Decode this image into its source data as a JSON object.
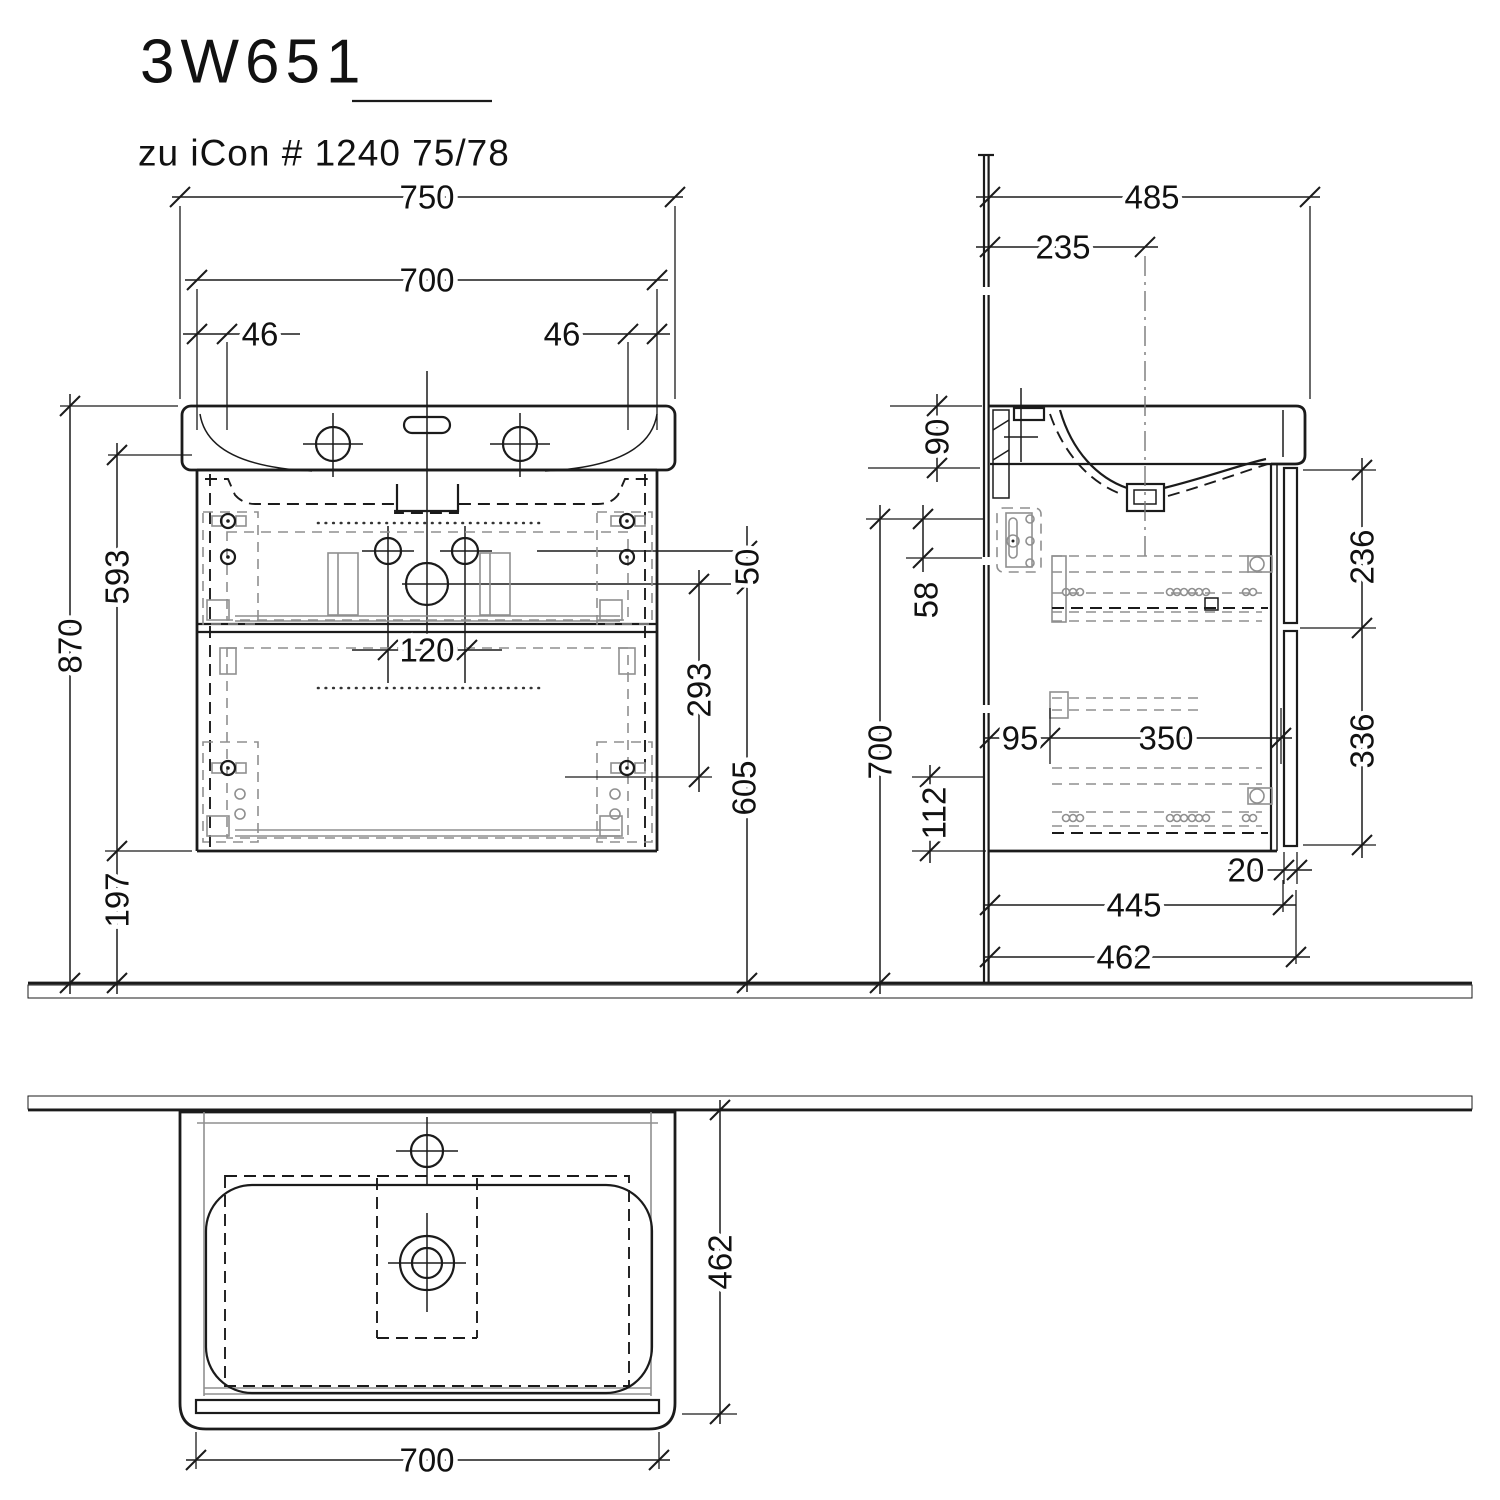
{
  "drawing": {
    "title": "3W651",
    "subtitle": "zu iCon # 1240 75/78",
    "type": "vanity-unit-technical-drawing",
    "line_color": "#1b1b1b",
    "hardware_color": "#8f8f8f",
    "views": [
      "front-view",
      "side-view",
      "plan-view"
    ]
  },
  "dims": {
    "front": {
      "total_width": "750",
      "cabinet_width": "700",
      "left_offset": "46",
      "right_offset": "46",
      "hole_spacing": "120",
      "height_total": "870",
      "cabinet_height": "593",
      "floor_clearance": "197",
      "drain_offset": "50",
      "fixing_span": "293",
      "drain_height": "605"
    },
    "side": {
      "depth_total": "485",
      "drain_depth": "235",
      "rim_height": "90",
      "top_offset": "58",
      "wall_height": "700",
      "bottom_offset": "112",
      "rear_gap": "95",
      "slide_length": "350",
      "upper_front": "236",
      "lower_front": "336",
      "front_thickness": "20",
      "body_depth": "445",
      "overall_depth": "462"
    },
    "plan": {
      "depth": "462",
      "width": "700"
    }
  }
}
